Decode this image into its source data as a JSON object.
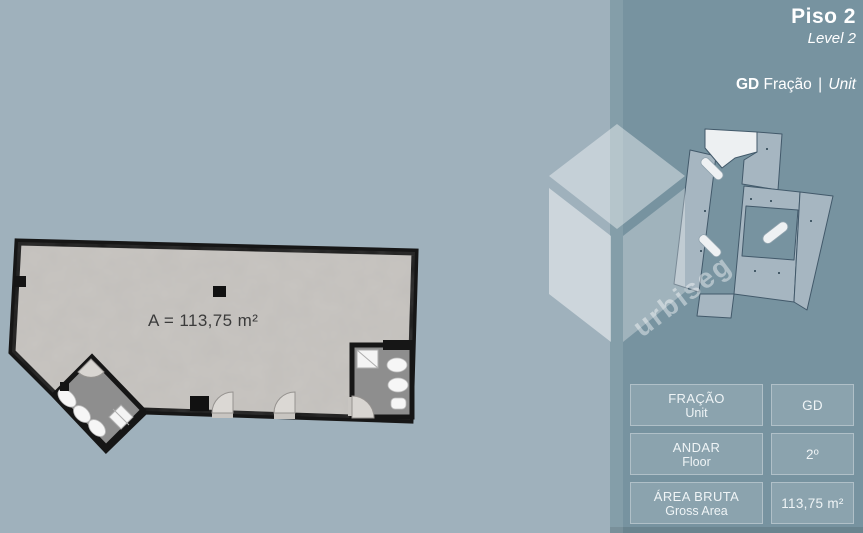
{
  "page": {
    "title": "Piso 2",
    "subtitle": "Level 2"
  },
  "unit_header": {
    "code": "GD",
    "label_pt": "Fração",
    "separator": "|",
    "label_en": "Unit"
  },
  "floor_plan": {
    "area_text": "A = 113,75 m²"
  },
  "watermark": {
    "brand": "urbiseg"
  },
  "details_table": {
    "rows": [
      {
        "label_pt": "FRAÇÃO",
        "label_en": "Unit",
        "value": "GD"
      },
      {
        "label_pt": "ANDAR",
        "label_en": "Floor",
        "value": "2º"
      },
      {
        "label_pt": "ÁREA BRUTA",
        "label_en": "Gross Area",
        "value": "113,75 m²"
      }
    ]
  },
  "colors": {
    "main_background": "#9fb1bc",
    "sidebar_background": "#7793a0",
    "cell_background": "#8ba2ad",
    "floor": "#c8c5c1",
    "wall": "#161616",
    "bathroom_floor": "#8e8e8e",
    "fixture": "#f5f5f5",
    "highlighted_unit": "#edf0f2",
    "miniplan_unit": "#a6b6c1",
    "text": "#ffffff",
    "plan_text": "#3b3b3b"
  }
}
